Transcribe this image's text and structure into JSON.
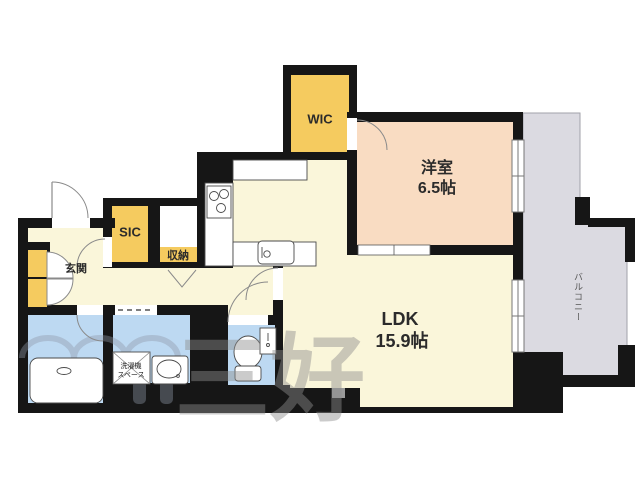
{
  "plan": {
    "rooms": {
      "wic": "WIC",
      "sic": "SIC",
      "storage": "収納",
      "entrance": "玄関",
      "western_room": {
        "name": "洋室",
        "size": "6.5帖"
      },
      "ldk": {
        "name": "LDK",
        "size": "15.9帖"
      },
      "balcony": "バルコニー",
      "laundry_space": {
        "line1": "洗濯機",
        "line2": "スペース"
      }
    },
    "watermark": "三好",
    "colors": {
      "closet_yellow": "#f5cb5f",
      "room_peach": "#f9dcc2",
      "floor_cream": "#faf6da",
      "wet_area_blue": "#bdd9f2",
      "balcony_gray": "#dbdae1",
      "wall_black": "#161616"
    }
  }
}
